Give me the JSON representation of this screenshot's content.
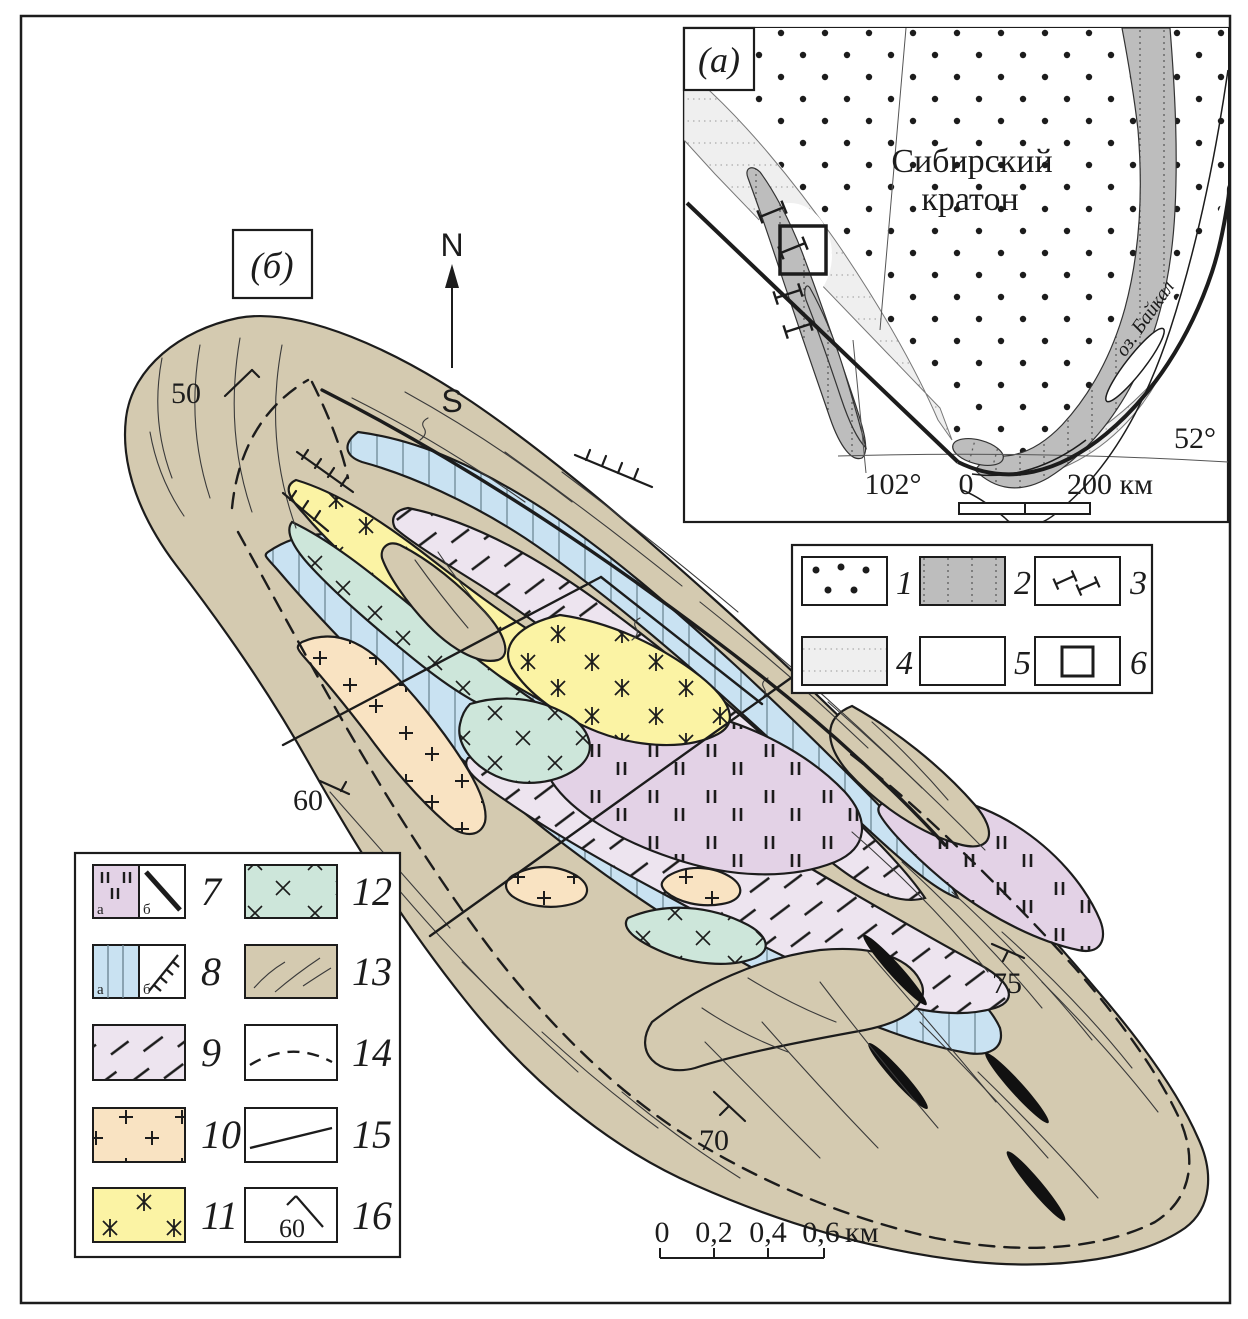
{
  "panel_a": {
    "tag": "(а)",
    "craton_title_line1": "Сибирский",
    "craton_title_line2": "кратон",
    "lake_label": "оз. Байкал",
    "longitude_label": "102°",
    "latitude_label": "52°",
    "scale": {
      "zero": "0",
      "end": "200 км"
    },
    "legend": {
      "items": [
        "1",
        "2",
        "3",
        "4",
        "5",
        "6"
      ]
    }
  },
  "panel_b": {
    "tag": "(б)",
    "compass": {
      "north": "N",
      "south": "S"
    },
    "dip_labels": {
      "nw": "50",
      "w": "60",
      "s": "70",
      "se": "75"
    },
    "scale": {
      "t0": "0",
      "t1": "0,2",
      "t2": "0,4",
      "t3": "0,6",
      "unit": "км"
    },
    "legend": {
      "item7": {
        "num": "7",
        "a": "а",
        "b": "б"
      },
      "item8": {
        "num": "8",
        "a": "а",
        "b": "б"
      },
      "item9": {
        "num": "9"
      },
      "item10": {
        "num": "10"
      },
      "item11": {
        "num": "11"
      },
      "item12": {
        "num": "12"
      },
      "item13": {
        "num": "13"
      },
      "item14": {
        "num": "14"
      },
      "item15": {
        "num": "15"
      },
      "item16": {
        "num": "16",
        "dip": "60"
      }
    }
  },
  "colors": {
    "tan": "#d4cab0",
    "blue": "#c9e2f2",
    "yellow": "#fbf3a4",
    "teal": "#cde6da",
    "peach": "#f9e3c2",
    "lilac": "#e3d2e6",
    "pink": "#ede4ef",
    "gray_unit": "#bdbdbd",
    "light_gray_unit": "#efefef",
    "black_unit": "#111111",
    "line": "#1c1c1c"
  }
}
